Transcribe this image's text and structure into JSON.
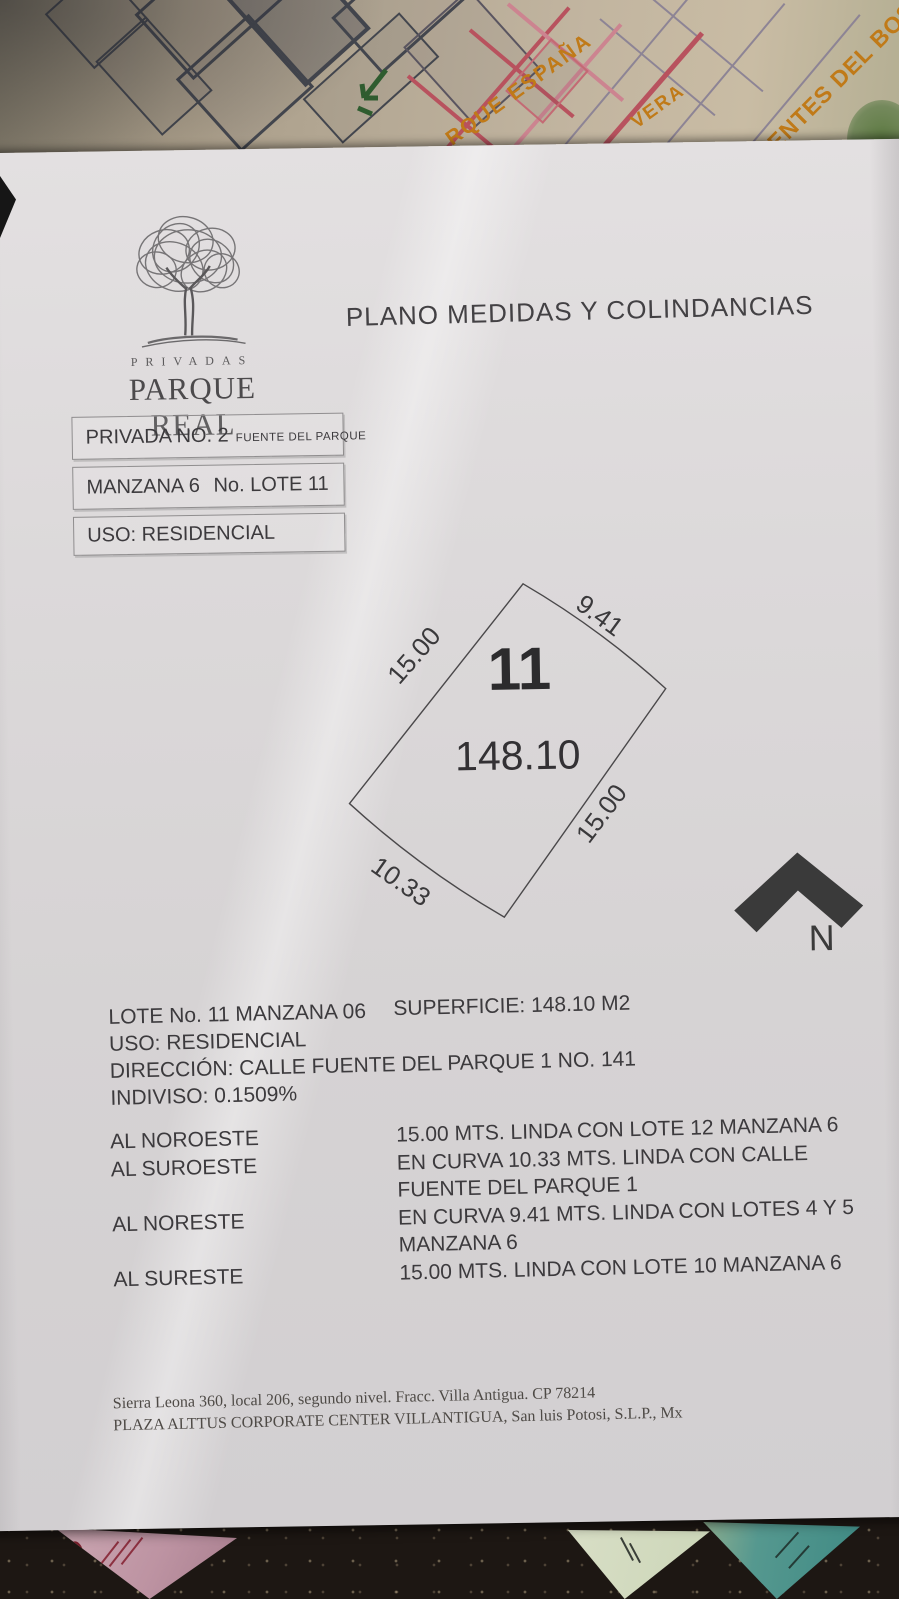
{
  "logo": {
    "privadas": "PRIVADAS",
    "parque_real": "PARQUE REAL"
  },
  "title": "PLANO MEDIDAS Y COLINDANCIAS",
  "boxes": {
    "privada_main": "PRIVADA NO. 2",
    "privada_sub": "FUENTE DEL PARQUE",
    "manzana": "MANZANA 6",
    "lote": "No. LOTE 11",
    "uso": "USO: RESIDENCIAL"
  },
  "diagram": {
    "lot_number": "11",
    "area": "148.10",
    "side_nw": "15.00",
    "side_ne": "9.41",
    "side_se": "15.00",
    "side_sw": "10.33",
    "north": "N"
  },
  "details": {
    "line1_left": "LOTE No. 11  MANZANA 06",
    "line1_right": "SUPERFICIE: 148.10 M2",
    "line2": "USO: RESIDENCIAL",
    "line3": "DIRECCIÓN: CALLE FUENTE DEL PARQUE 1 NO. 141",
    "line4": "INDIVISO: 0.1509%"
  },
  "boundaries": [
    {
      "direction": "AL NOROESTE",
      "description": "15.00 MTS. LINDA CON LOTE 12 MANZANA 6"
    },
    {
      "direction": "AL SUROESTE",
      "description": "EN CURVA 10.33 MTS. LINDA CON CALLE FUENTE DEL PARQUE 1"
    },
    {
      "direction": "AL NORESTE",
      "description": "EN CURVA 9.41 MTS. LINDA CON LOTES 4 Y 5 MANZANA 6"
    },
    {
      "direction": "AL SURESTE",
      "description": "15.00 MTS. LINDA CON LOTE 10 MANZANA 6"
    }
  ],
  "footer": {
    "line1": "Sierra Leona 360, local 206, segundo nivel. Fracc. Villa Antigua. CP 78214",
    "line2": "PLAZA ALTTUS CORPORATE CENTER VILLANTIGUA, San luis Potosi, S.L.P., Mx"
  },
  "background_map": {
    "label_parque_espana": "RQUE ESPAÑA",
    "label_vera": "VERA",
    "label_fuentes": "FUENTES DEL BOSQ"
  },
  "desk": {
    "pink_letter": "D"
  },
  "colors": {
    "paper": "#dcd9da",
    "ink": "#3c3a3d",
    "map_orange": "#c07a18",
    "map_red": "#b8525e",
    "desk": "#1d1713",
    "north_arrow": "#3a3a3a"
  }
}
